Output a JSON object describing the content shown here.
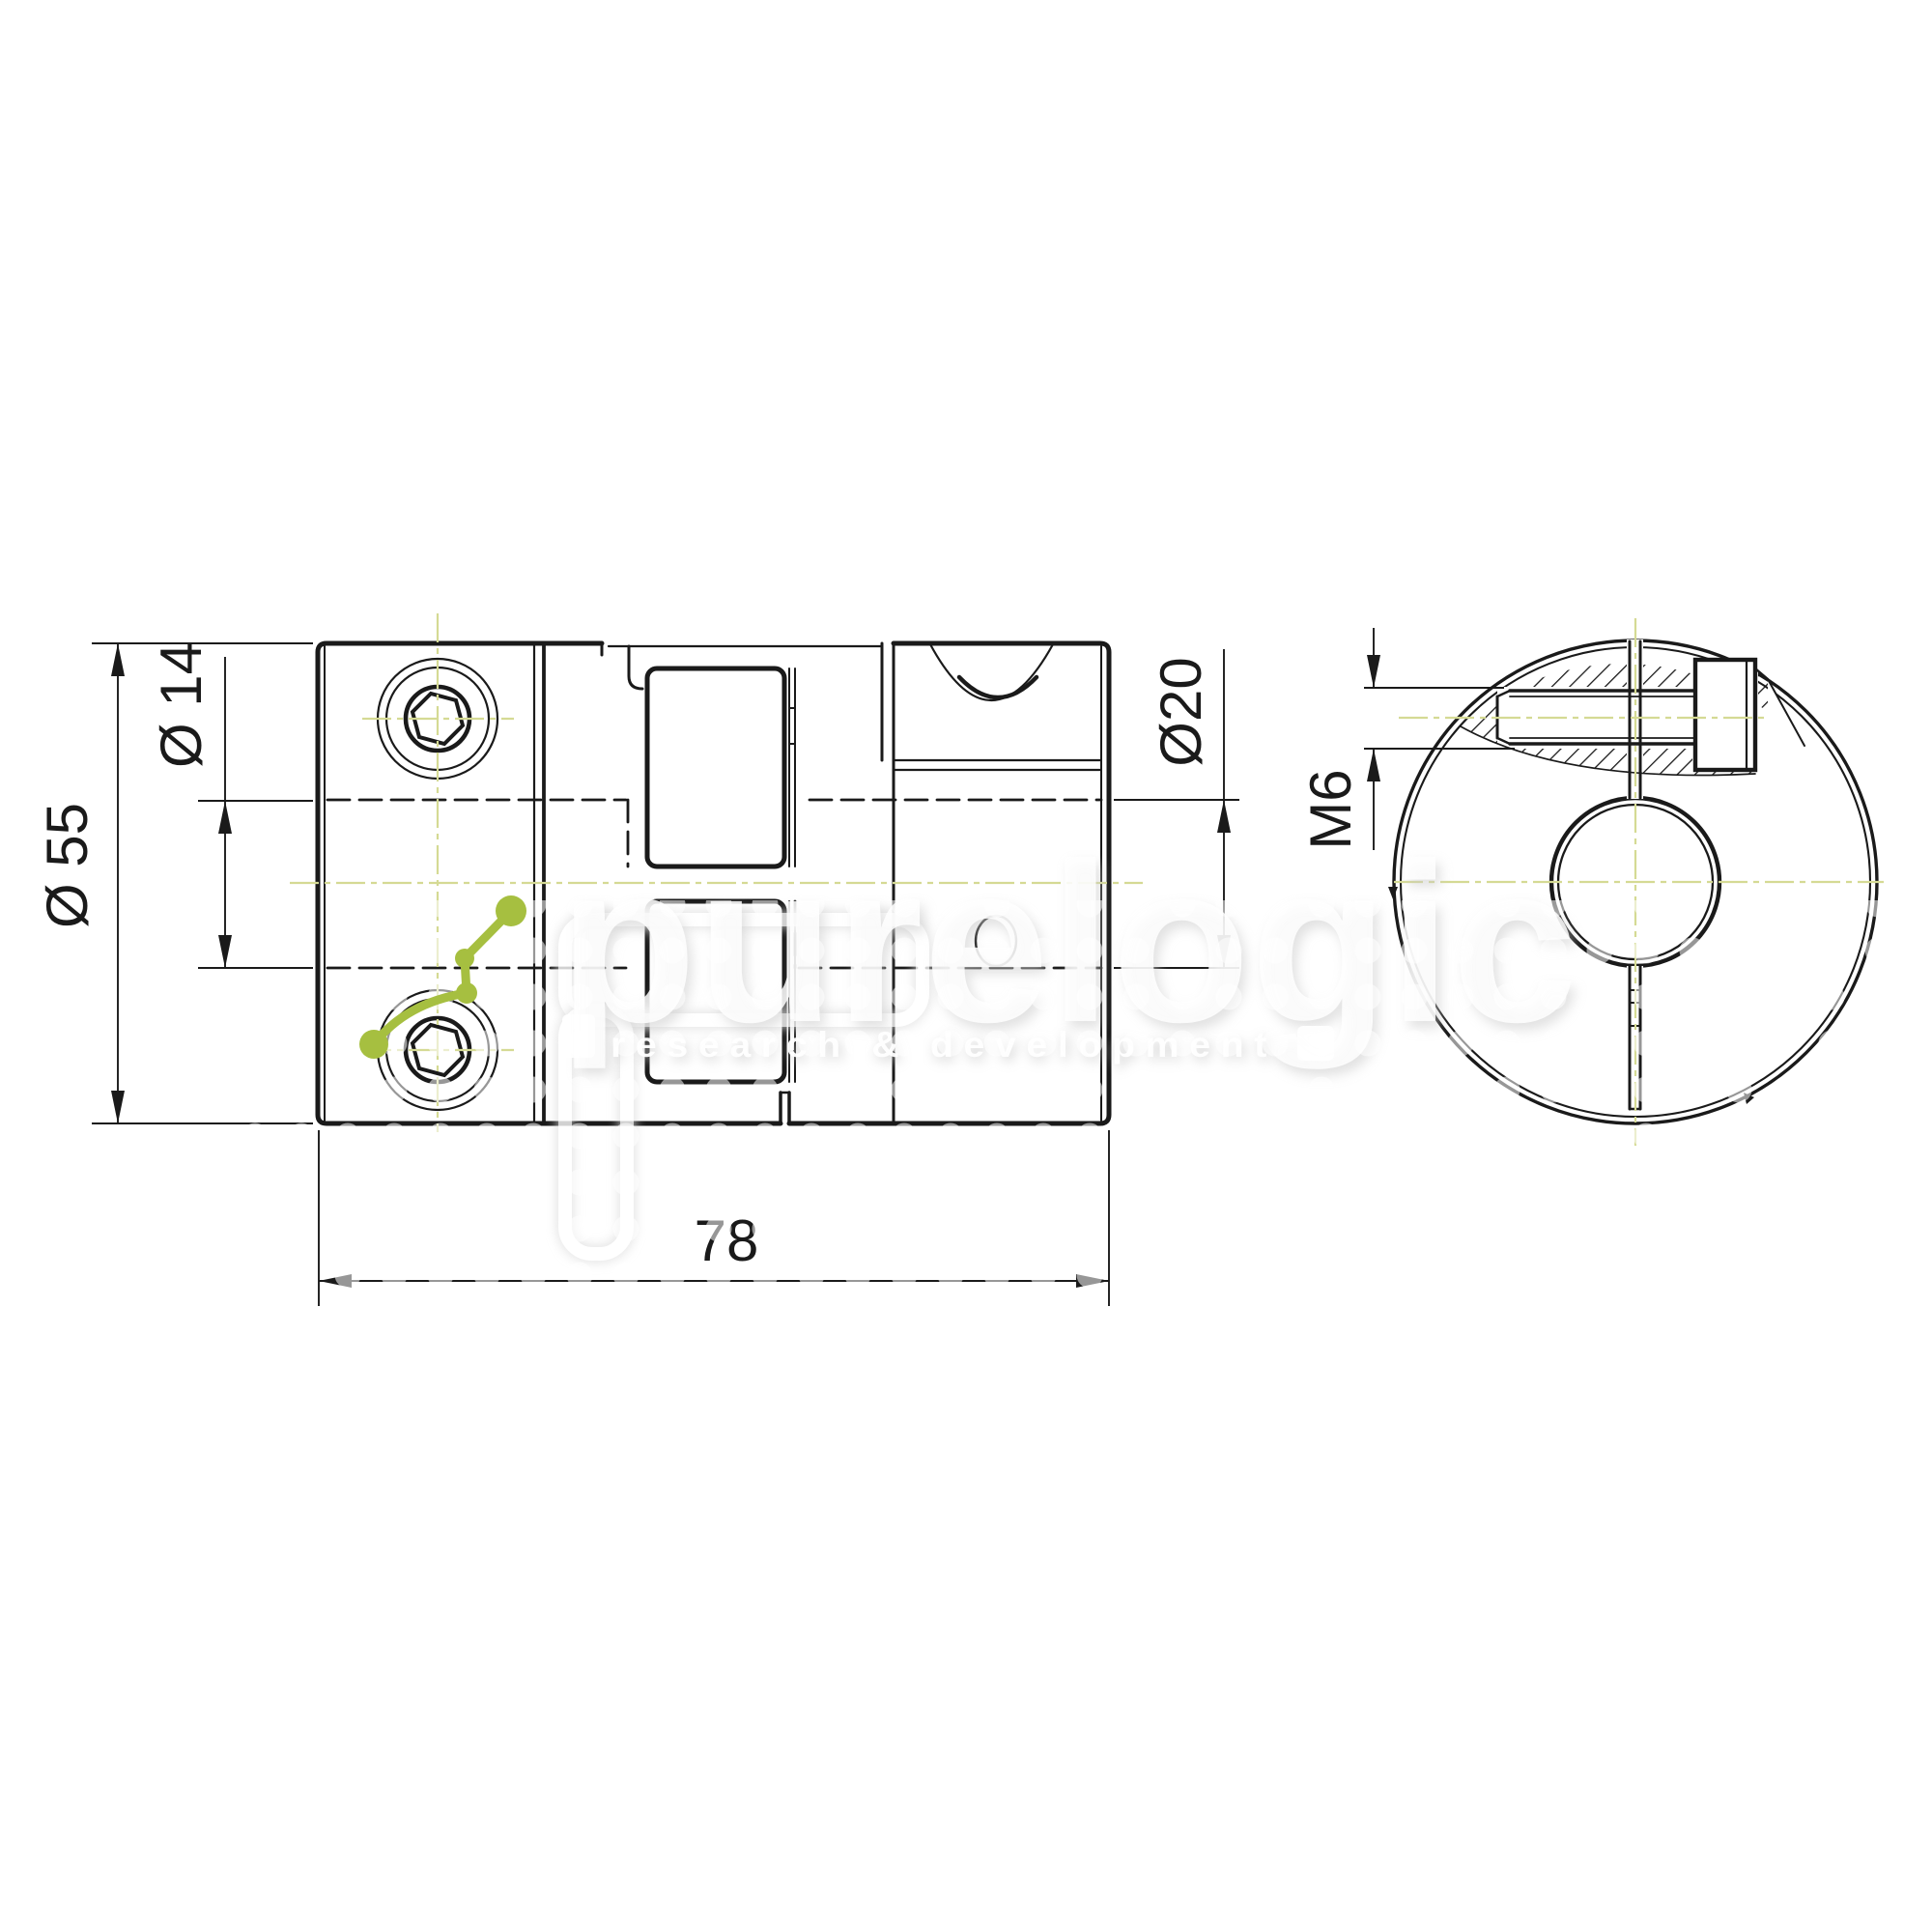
{
  "drawing": {
    "kind": "technical-drawing",
    "dimensions": {
      "outer_diameter": "Ø 55",
      "left_bore": "Ø 14",
      "right_bore": "Ø20",
      "screw_thread": "M6",
      "overall_length": "78"
    },
    "watermark": {
      "brand": "purelogic",
      "tagline": "research & development",
      "logo_icon": "node-link-molecule-icon",
      "pattern_icon": "dot-grid-pattern"
    },
    "colors": {
      "line": "#1a1a1a",
      "centerline": "#d5da94",
      "accent_green": "#a6bf40",
      "watermark_gray": "#c9c9c9",
      "background": "#ffffff"
    }
  }
}
